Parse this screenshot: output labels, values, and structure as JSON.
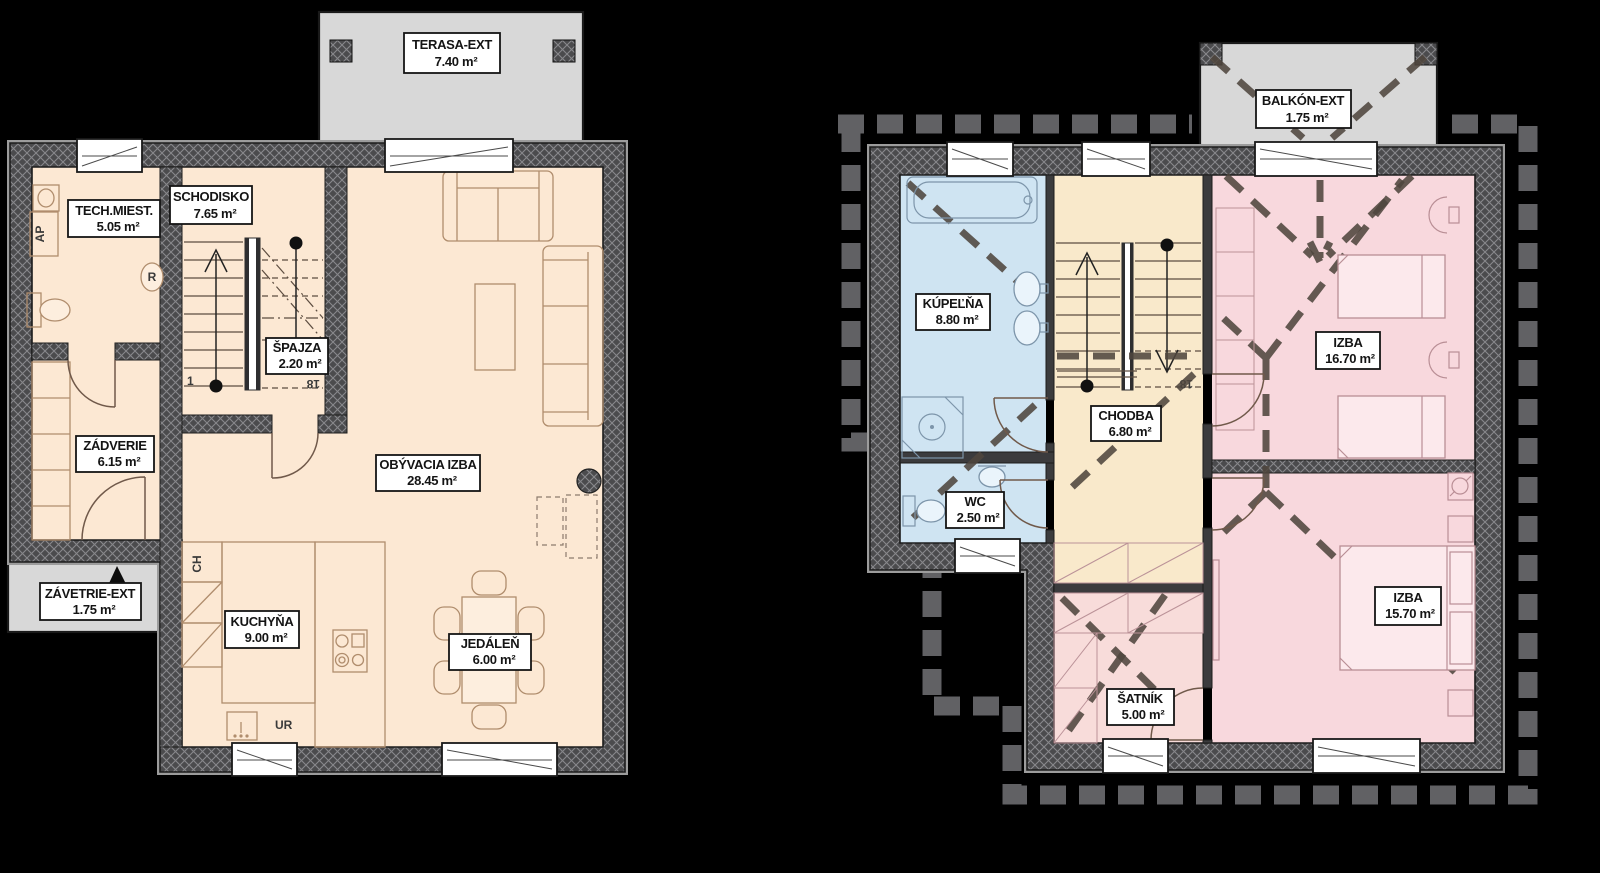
{
  "title": "Floor plans of a two-storey house (Slovak labels)",
  "colors": {
    "background": "#000000",
    "floor_peach": "#fce8d3",
    "bath_blue": "#cfe4f2",
    "hall_tan": "#f9e9cb",
    "bedroom_pink": "#f8d8dd",
    "closet_pink": "#f8dcda",
    "exterior_gray": "#d8d8d8",
    "wall_dark": "#4b4b4d",
    "roof_dash_gray": "#616164"
  },
  "floor1": {
    "terrace": {
      "name": "TERASA-EXT",
      "area": "7.40 m²"
    },
    "rooms": {
      "tech": {
        "name": "TECH.MIEST.",
        "area": "5.05 m²"
      },
      "stairs": {
        "name": "SCHODISKO",
        "area": "7.65 m²"
      },
      "pantry": {
        "name": "ŠPAJZA",
        "area": "2.20 m²"
      },
      "hallway": {
        "name": "ZÁDVERIE",
        "area": "6.15 m²"
      },
      "living": {
        "name": "OBÝVACIA IZBA",
        "area": "28.45 m²"
      },
      "porch": {
        "name": "ZÁVETRIE-EXT",
        "area": "1.75 m²"
      },
      "kitchen": {
        "name": "KUCHYŇA",
        "area": "9.00 m²"
      },
      "dining": {
        "name": "JEDÁLEŇ",
        "area": "6.00 m²"
      }
    },
    "annotations": {
      "washer": "AP",
      "fridge": "CH",
      "dishwasher": "UR",
      "boiler": "R",
      "stair_first": "1",
      "stair_last": "18"
    }
  },
  "floor2": {
    "balcony": {
      "name": "BALKÓN-EXT",
      "area": "1.75 m²"
    },
    "rooms": {
      "bathroom": {
        "name": "KÚPEĽŇA",
        "area": "8.80 m²"
      },
      "hall": {
        "name": "CHODBA",
        "area": "6.80 m²"
      },
      "bedroom1": {
        "name": "IZBA",
        "area": "16.70 m²"
      },
      "wc": {
        "name": "WC",
        "area": "2.50 m²"
      },
      "bedroom2": {
        "name": "IZBA",
        "area": "15.70 m²"
      },
      "closet": {
        "name": "ŠATNÍK",
        "area": "5.00 m²"
      }
    },
    "annotations": {
      "stair_last": "18"
    }
  }
}
